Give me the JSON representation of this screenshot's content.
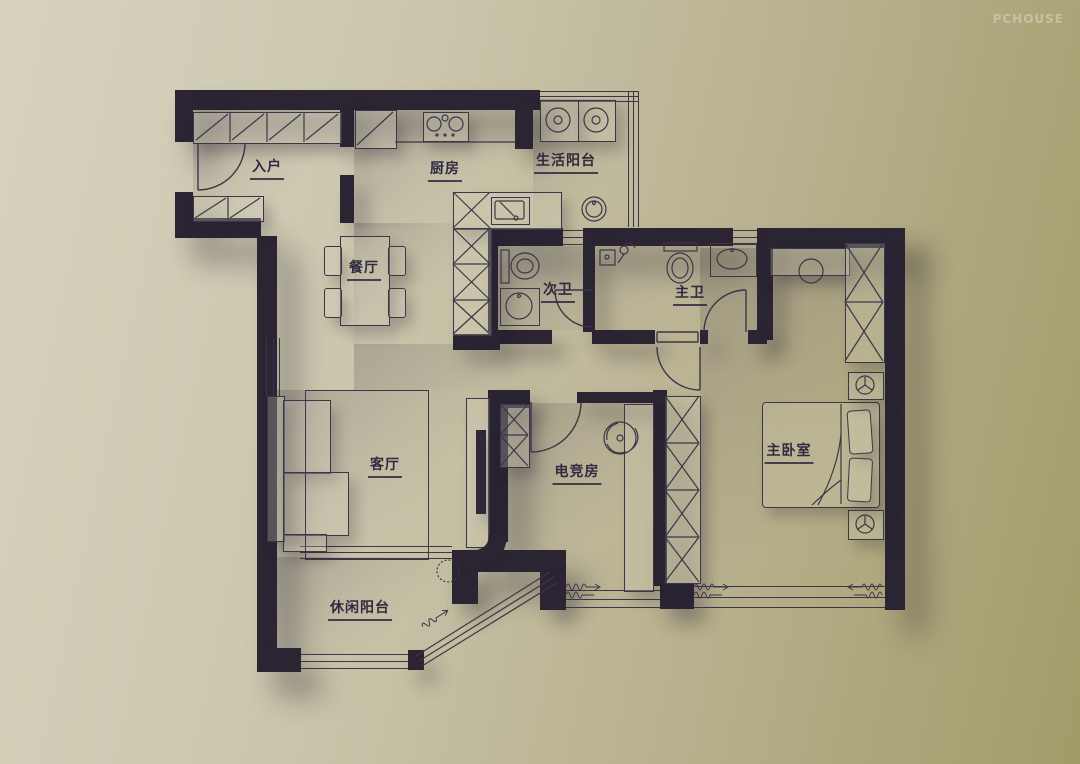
{
  "watermark": {
    "label": "PCHOUSE"
  },
  "rooms": [
    {
      "id": "entry",
      "label": "入户"
    },
    {
      "id": "kitchen",
      "label": "厨房"
    },
    {
      "id": "service-balcony",
      "label": "生活阳台"
    },
    {
      "id": "dining",
      "label": "餐厅"
    },
    {
      "id": "guest-bath",
      "label": "次卫"
    },
    {
      "id": "master-bath",
      "label": "主卫"
    },
    {
      "id": "living",
      "label": "客厅"
    },
    {
      "id": "gaming-room",
      "label": "电竞房"
    },
    {
      "id": "master-bedroom",
      "label": "主卧室"
    },
    {
      "id": "leisure-balcony",
      "label": "休闲阳台"
    }
  ],
  "palette": {
    "background_left": "#d7d2bc",
    "background_right": "#a29b69",
    "wall": "#2a2433",
    "line": "#3c3648",
    "label_text": "#2f2a3e",
    "watermark_text": "rgba(250,248,238,0.33)"
  },
  "icons": {
    "stove": "stove-icon",
    "kitchen_sink": "kitchen-sink-icon",
    "fridge": "fridge-icon",
    "washer": "washing-machine-icon",
    "round_sink": "round-sink-icon",
    "toilet": "toilet-icon",
    "shower": "shower-icon",
    "vanity_sink": "vanity-sink-icon",
    "ceiling_fan": "ceiling-fan-icon",
    "bed": "bed",
    "lamp": "lamp-icon",
    "plant": "plant-icon",
    "curtain": "curtain-symbol",
    "door_arc": "door-arc"
  }
}
